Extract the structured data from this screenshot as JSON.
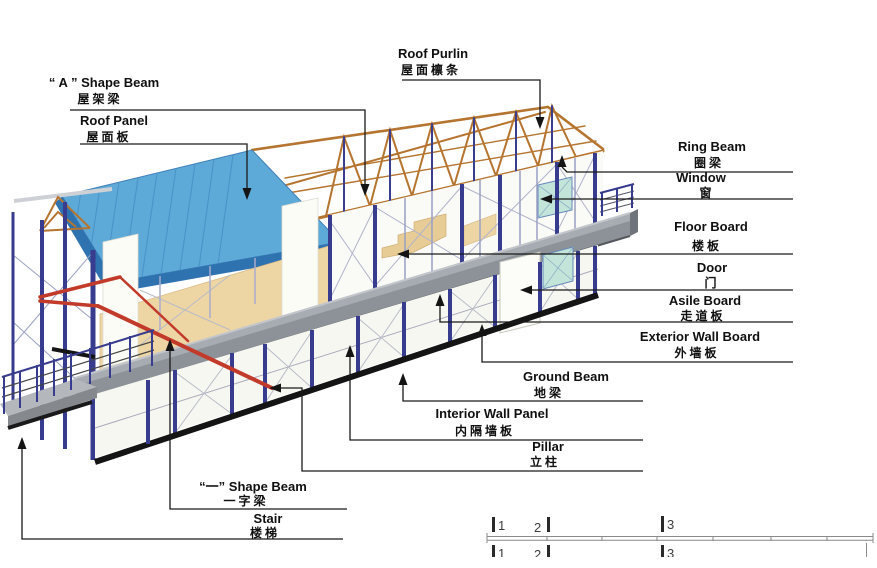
{
  "figure": {
    "type": "isometric prefab-house assembly diagram",
    "background": "#ffffff"
  },
  "labels": {
    "a_shape_beam": {
      "en": "“ A ” Shape Beam",
      "zh": "屋架梁"
    },
    "roof_panel": {
      "en": "Roof Panel",
      "zh": "屋面板"
    },
    "roof_purlin": {
      "en": "Roof Purlin",
      "zh": "屋面檩条"
    },
    "ring_beam": {
      "en": "Ring Beam",
      "zh": "圈梁"
    },
    "window": {
      "en": "Window",
      "zh": "窗"
    },
    "floor_board": {
      "en": "Floor Board",
      "zh": "楼板"
    },
    "door": {
      "en": "Door",
      "zh": "门"
    },
    "asile_board": {
      "en": "Asile Board",
      "zh": "走道板"
    },
    "exterior_wall_board": {
      "en": "Exterior Wall Board",
      "zh": "外墙板"
    },
    "ground_beam": {
      "en": "Ground Beam",
      "zh": "地梁"
    },
    "interior_wall_panel": {
      "en": "Interior Wall Panel",
      "zh": "内隔墙板"
    },
    "pillar": {
      "en": "Pillar",
      "zh": "立柱"
    },
    "one_shape_beam": {
      "en": "“一” Shape Beam",
      "zh": "一字梁"
    },
    "stair": {
      "en": "Stair",
      "zh": "楼梯"
    }
  },
  "scale_bar": {
    "ticks": [
      "1",
      "2",
      "3"
    ]
  },
  "colors": {
    "roof_panel_blue": "#5da9d7",
    "roof_fascia_blue": "#2e72b0",
    "truss_orange": "#b5742f",
    "pillar_blue": "#383c8e",
    "one_shape_beam_red": "#c23a2a",
    "floor_board_tan": "#eed5a4",
    "asile_board_gray": "#8d9298",
    "ground_beam_black": "#141414",
    "window_teal": "#c2e4d9",
    "leader_line": "#1a1a1a"
  }
}
